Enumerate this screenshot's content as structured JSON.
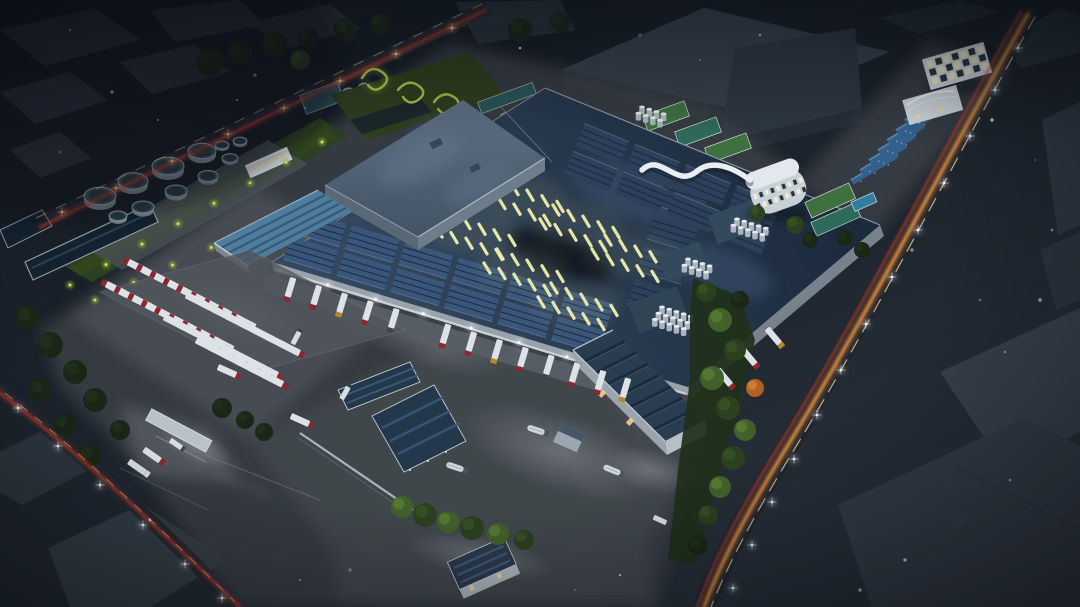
{
  "scene": {
    "title": "Aerial night rendering of an industrial factory campus",
    "description": "Aerial dusk architectural rendering of a large factory campus: a huge warehouse with navy solar-panel roof and glowing yellow skylight strips, raised hall, rooftop silo terraces, loading docks with semi trailers, truck parking rows, circular water-treatment tanks and ponds, green landscaping, solar carports, dormitory blocks, and perimeter roads with warm traffic light trails and street lamps.",
    "style": "architectural-visualization",
    "time_of_day": "night",
    "camera": "aerial-oblique"
  },
  "palette": {
    "bg_top": "#11171f",
    "bg_mid": "#1b222b",
    "bg_low": "#272f39",
    "neighbor": "#39434e",
    "neighbor_light": "#49545f",
    "neighbor_dark": "#2a333d",
    "road": "#20262e",
    "yard": "#474c53",
    "yard_dark": "#41464c",
    "yard_pale": "#51565c",
    "roof_sw": "#33475e",
    "roof_ne": "#1c2a3e",
    "upper_hi": "#5f7285",
    "upper_lo": "#415163",
    "fascia": "#c6ced6",
    "wall_light": "#98a2ab",
    "wall_mid": "#77828c",
    "pv_dark": "#2c405a",
    "pv_mid": "#3a567a",
    "pv_teal": "#4f7d9c",
    "pv_line": "#16243a",
    "skylight": "#efefae",
    "white_bldg": "#d3d9de",
    "window_lit": "#f3eccf",
    "window_dark": "#2c343c",
    "window_warm": "#ffd98f",
    "truck_white": "#dde2e6",
    "truck_red": "#8e2630",
    "truck_amber": "#b8862c",
    "tank_body": "#77848d",
    "tank_top": "#33505c",
    "pond": "#13222e",
    "pond_rim": "#8f9aa2",
    "green_dark": "#1a2616",
    "green_mid": "#2b401f",
    "green_light": "#42612a",
    "green_neon": "#b9d14a",
    "court_green": "#3e7040",
    "court_teal": "#2e6a5a",
    "pool": "#2f7da0",
    "trail_orange": "#ff9a3c",
    "trail_red": "#e0402e",
    "trail_white": "#ffd9a6",
    "glint": "#f4f8fb",
    "lamp_warm": "#ffcf8e",
    "tree_orange": "#b26024",
    "silo": "#aab4bc",
    "silo_top": "#e6ebef",
    "terrace": "#33495c"
  },
  "counts": {
    "water_tanks": 11,
    "skylight_clusters": 6,
    "skylight_strips": 60,
    "loading_dock_trucks": 16,
    "parked_trailers": 40,
    "rooftop_pv_blocks": 24,
    "silo_clusters": 4,
    "solar_carport_rows": 7,
    "street_lights": 27,
    "roads_with_traffic_trails": 3
  },
  "features": [
    "main factory hall with solar roof and lit skylights",
    "raised upper hall",
    "loading docks with docked semi trailers",
    "trailer parking rows with red-cab trucks",
    "circular water treatment tanks and ponds",
    "rooftop silo terraces",
    "solar carports and dormitory buildings",
    "entrance gate with queued trucks",
    "perimeter roads with traffic light trails",
    "landscaped greenery with ground lighting"
  ]
}
